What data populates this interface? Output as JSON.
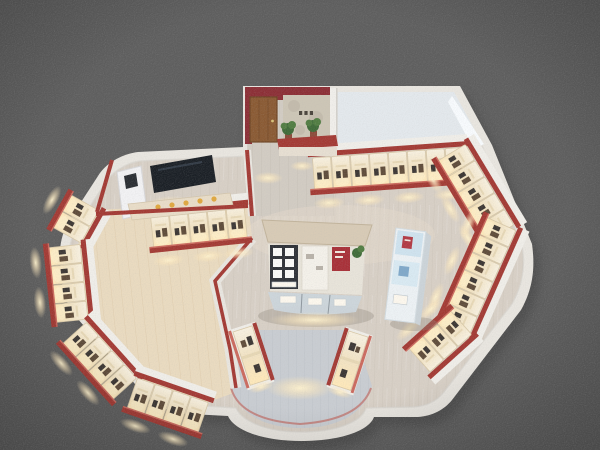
{
  "meta": {
    "description": "3D bird's-eye cutaway render of an exhibition showroom floor plan on a gray background",
    "image_type": "architectural 3D render"
  },
  "regions": {
    "entrance_lobby": "top lobby with wood door, stone feature wall, tiny wall sign and two potted plants",
    "empty_room": "unfurnished white room at top right with bright window",
    "media_room": "top-left room with wall screen, white kiosk and demo counter with yellow items",
    "display_walls": "perimeter shelving walls with warm-lit product compartments and red trim caps",
    "display_island": "central island with dark shelf grid, white boxes, red sign panel and glass counters",
    "blue_stand": "light-blue tiered display stand on right side of hall",
    "entrance": "curved bottom entrance alcove flanked by two lit display pillars"
  },
  "colors": {
    "bg_gray": "#5e5e5e",
    "mass_shadow": "#3e3e3e",
    "wall_white": "#e9e6e0",
    "wall_edge": "#d9d6d0",
    "trim_red": "#a33a34",
    "trim_red_light": "#cb6a5e",
    "lobby_maroon": "#8c2f36",
    "shelf_edge": "#d9c9a8",
    "divider_cream": "#e6d6b4",
    "product_dark": "#3c3734",
    "product_brown": "#5f4c3a",
    "floor_main": "#d8d0c6",
    "floor_main_line": "#cdc4b9",
    "floor_warm": "#eadbc0",
    "floor_warm_line": "#ddcaa9",
    "floor_gray": "#c9cdd2",
    "floor_gray_line": "#bdc2c8",
    "lobby_floor": "#d2ccc3",
    "lobby_floor_line": "#c6bfb5",
    "room_floor": "#e4e9ed",
    "window_glow": "#fafdff",
    "door_brown": "#8a5a33",
    "door_frame": "#6e4526",
    "door_handle": "#d8c27a",
    "stone_wall": "#cdc6b6",
    "sign_dark": "#4a443c",
    "plant_dark": "#3f6b38",
    "plant_light": "#517d42",
    "pot_red": "#8c4b3a",
    "island_frame": "#d8cbb6",
    "island_frame_edge": "#c2b49c",
    "island_body": "#e8e4da",
    "island_dark": "#2f3238",
    "island_white": "#f4f1ea",
    "box_white": "#fafaf8",
    "sign_red": "#a83038",
    "counter_glass": "#ccd6dc",
    "counter_lit": "#fdf8ee",
    "counter_mullion": "#8e979e",
    "stand_body": "#edf2f5",
    "stand_edge": "#d4dde2",
    "stand_blue": "#cfe3ef",
    "stand_blue2": "#d9eaf3",
    "stand_red": "#b23a44",
    "stand_mark_blue": "#7fa8c9",
    "stand_side": "#ccd4d9",
    "tv_black": "#1b2026",
    "tv_sheen": "#3a4450",
    "kiosk_white": "#f2f2f4",
    "kiosk_screen": "#2a2e33",
    "counter_beige": "#e9ddc8",
    "accent_yellow": "#e0a83f",
    "glow_core": "#fff3cf",
    "glow_mid": "#ffe9bd",
    "back_band": "#f0eee9",
    "alcove_line": "#c27b77",
    "cell_top": "#f8f1e1",
    "cell_mid": "#f2e3c3",
    "cell_bottom": "#ffe9ba",
    "shadow_soft": "#8f887c"
  }
}
